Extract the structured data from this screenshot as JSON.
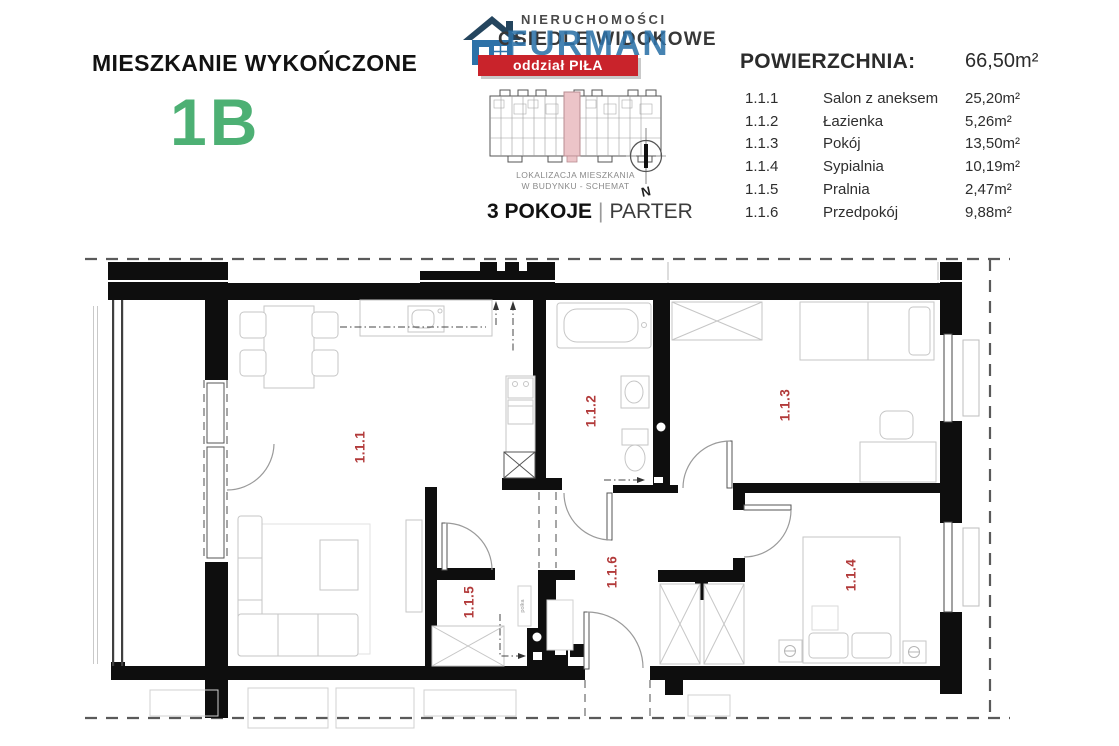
{
  "header": {
    "title": "MIESZKANIE WYKOŃCZONE",
    "unit": "1B",
    "unit_color": "#4DB074",
    "rooms_count": "3 POKOJE",
    "rooms_separator": "|",
    "floor": "PARTER"
  },
  "logo": {
    "line1": "NIERUCHOMOŚCI",
    "line2": "OSIEDLE WIDOKOWE",
    "brand": "FURMAN",
    "banner": "oddział PIŁA",
    "brand_color": "#2D72A8",
    "banner_color": "#C9232B"
  },
  "schematic": {
    "caption1": "LOKALIZACJA MIESZKANIA",
    "caption2": "W BUDYNKU - SCHEMAT",
    "compass": "N",
    "highlight_color": "#ECC4C8"
  },
  "table": {
    "heading": "POWIERZCHNIA:",
    "total": "66,50m²",
    "rows": [
      {
        "code": "1.1.1",
        "name": "Salon z aneksem",
        "area": "25,20m²"
      },
      {
        "code": "1.1.2",
        "name": "Łazienka",
        "area": "5,26m²"
      },
      {
        "code": "1.1.3",
        "name": "Pokój",
        "area": "13,50m²"
      },
      {
        "code": "1.1.4",
        "name": "Sypialnia",
        "area": "10,19m²"
      },
      {
        "code": "1.1.5",
        "name": "Pralnia",
        "area": "2,47m²"
      },
      {
        "code": "1.1.6",
        "name": "Przedpokój",
        "area": "9,88m²"
      }
    ]
  },
  "plan": {
    "label_color": "#B23A3A",
    "shelf_label": "polka"
  }
}
